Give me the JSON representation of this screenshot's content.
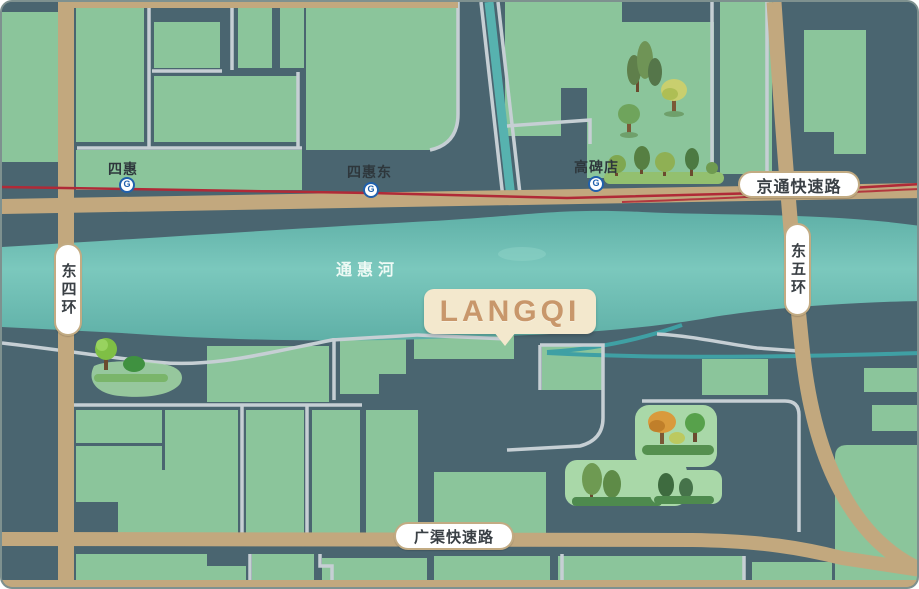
{
  "map": {
    "project_bubble": {
      "label": "LANGQI"
    },
    "river": {
      "label": "通惠河"
    },
    "roads": {
      "jingtong": {
        "label": "京通快速路"
      },
      "dongwuhuan": {
        "label": "东五环"
      },
      "dongsihuan": {
        "label": "东四环"
      },
      "guangqu": {
        "label": "广渠快速路"
      }
    },
    "stations": {
      "sihui": {
        "label": "四惠"
      },
      "sihuidong": {
        "label": "四惠东"
      },
      "gaobeidian": {
        "label": "高碑店"
      }
    },
    "metro_icon_glyph": "G",
    "colors": {
      "background": "#4A6570",
      "block_green": "#8BC59B",
      "park_green": "#A9D8A8",
      "river_teal": "#6FBFB5",
      "road_tan": "#C2A87E",
      "street_gray": "#C6CFD4",
      "metro_line_red": "#B02A37",
      "metro_icon_blue": "#2060AC",
      "bubble_fill": "#F3E8CD",
      "bubble_text": "#C8976B"
    }
  }
}
